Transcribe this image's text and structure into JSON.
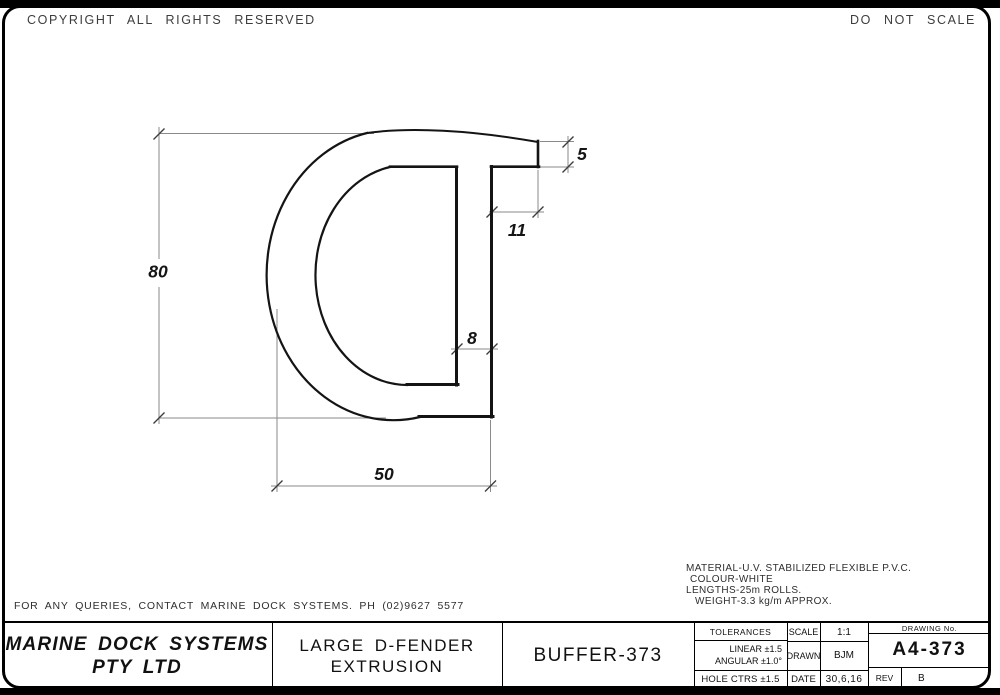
{
  "header": {
    "copyright": "COPYRIGHT ALL RIGHTS RESERVED",
    "do_not_scale": "DO NOT SCALE"
  },
  "dimensions": {
    "d80": "80",
    "d50": "50",
    "d11": "11",
    "d8": "8",
    "d5": "5"
  },
  "notes": {
    "material": "MATERIAL-U.V. STABILIZED FLEXIBLE P.V.C.",
    "colour": "COLOUR-WHITE",
    "lengths": "LENGTHS-25m ROLLS.",
    "weight": "WEIGHT-3.3 kg/m APPROX."
  },
  "footer": {
    "query_note": "FOR ANY QUERIES, CONTACT MARINE DOCK SYSTEMS. PH (02)9627 5577"
  },
  "title_block": {
    "company_line1": "MARINE DOCK SYSTEMS",
    "company_line2": "PTY LTD",
    "title_line1": "LARGE D-FENDER",
    "title_line2": "EXTRUSION",
    "product": "BUFFER-373",
    "tolerances_header": "TOLERANCES",
    "tolerance_linear": "LINEAR ±1.5",
    "tolerance_angular": "ANGULAR ±1.0°",
    "tolerance_hole_ctrs": "HOLE CTRS ±1.5",
    "scale_label": "SCALE",
    "scale_value": "1:1",
    "drawn_label": "DRAWN",
    "drawn_value": "BJM",
    "date_label": "DATE",
    "date_value": "30,6,16",
    "drawing_no_label": "DRAWING No.",
    "drawing_no": "A4-373",
    "rev_label": "REV",
    "rev_value": "B"
  },
  "colors": {
    "ink": "#141414",
    "dim_line": "#8a8a8a",
    "tick": "#3c3c3c"
  }
}
